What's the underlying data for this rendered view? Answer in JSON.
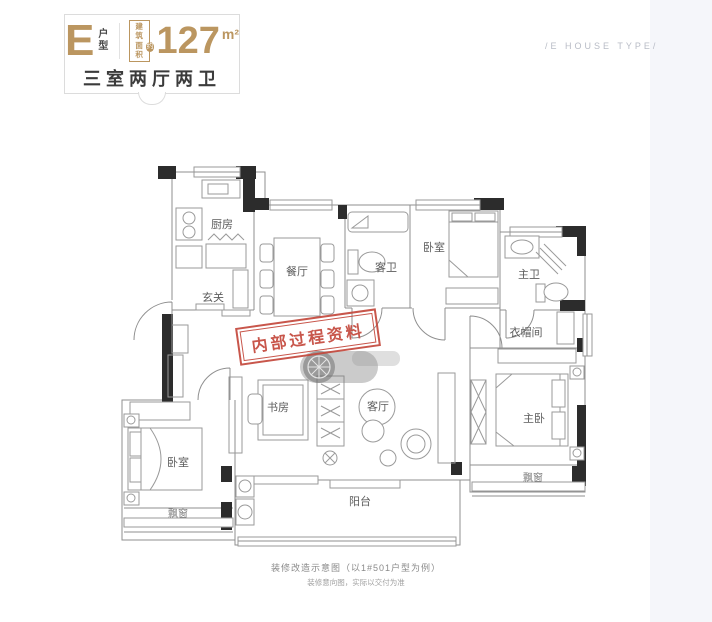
{
  "header": {
    "type_letter": "E",
    "type_word": "户型",
    "area_box_line1": "建筑",
    "area_box_line2": "面积",
    "area_approx": "约",
    "area_value": "127",
    "area_unit": "m²",
    "layout_summary": "三室两厅两卫",
    "side_caption": "/E HOUSE TYPE/"
  },
  "rooms": [
    {
      "label": "厨房"
    },
    {
      "label": "餐厅"
    },
    {
      "label": "玄关"
    },
    {
      "label": "客卫"
    },
    {
      "label": "卧室"
    },
    {
      "label": "主卫"
    },
    {
      "label": "衣帽间"
    },
    {
      "label": "书房"
    },
    {
      "label": "客厅"
    },
    {
      "label": "主卧"
    },
    {
      "label": "卧室"
    },
    {
      "label": "飘窗"
    },
    {
      "label": "飘窗"
    },
    {
      "label": "阳台"
    }
  ],
  "stamp": {
    "text": "内部过程资料"
  },
  "footer": {
    "line1": "装修改造示意图（以1#501户型为例）",
    "line2": "装修意向图，实际以交付为准"
  },
  "colors": {
    "gold": "#bb9660",
    "dark_text": "#3b3b3b",
    "wall_black": "#2c2c2c",
    "plan_line": "#8f8f8f",
    "stamp_red": "#c4483c",
    "caption_gray": "#8a8a8a",
    "right_strip": "#f5f6fa"
  }
}
